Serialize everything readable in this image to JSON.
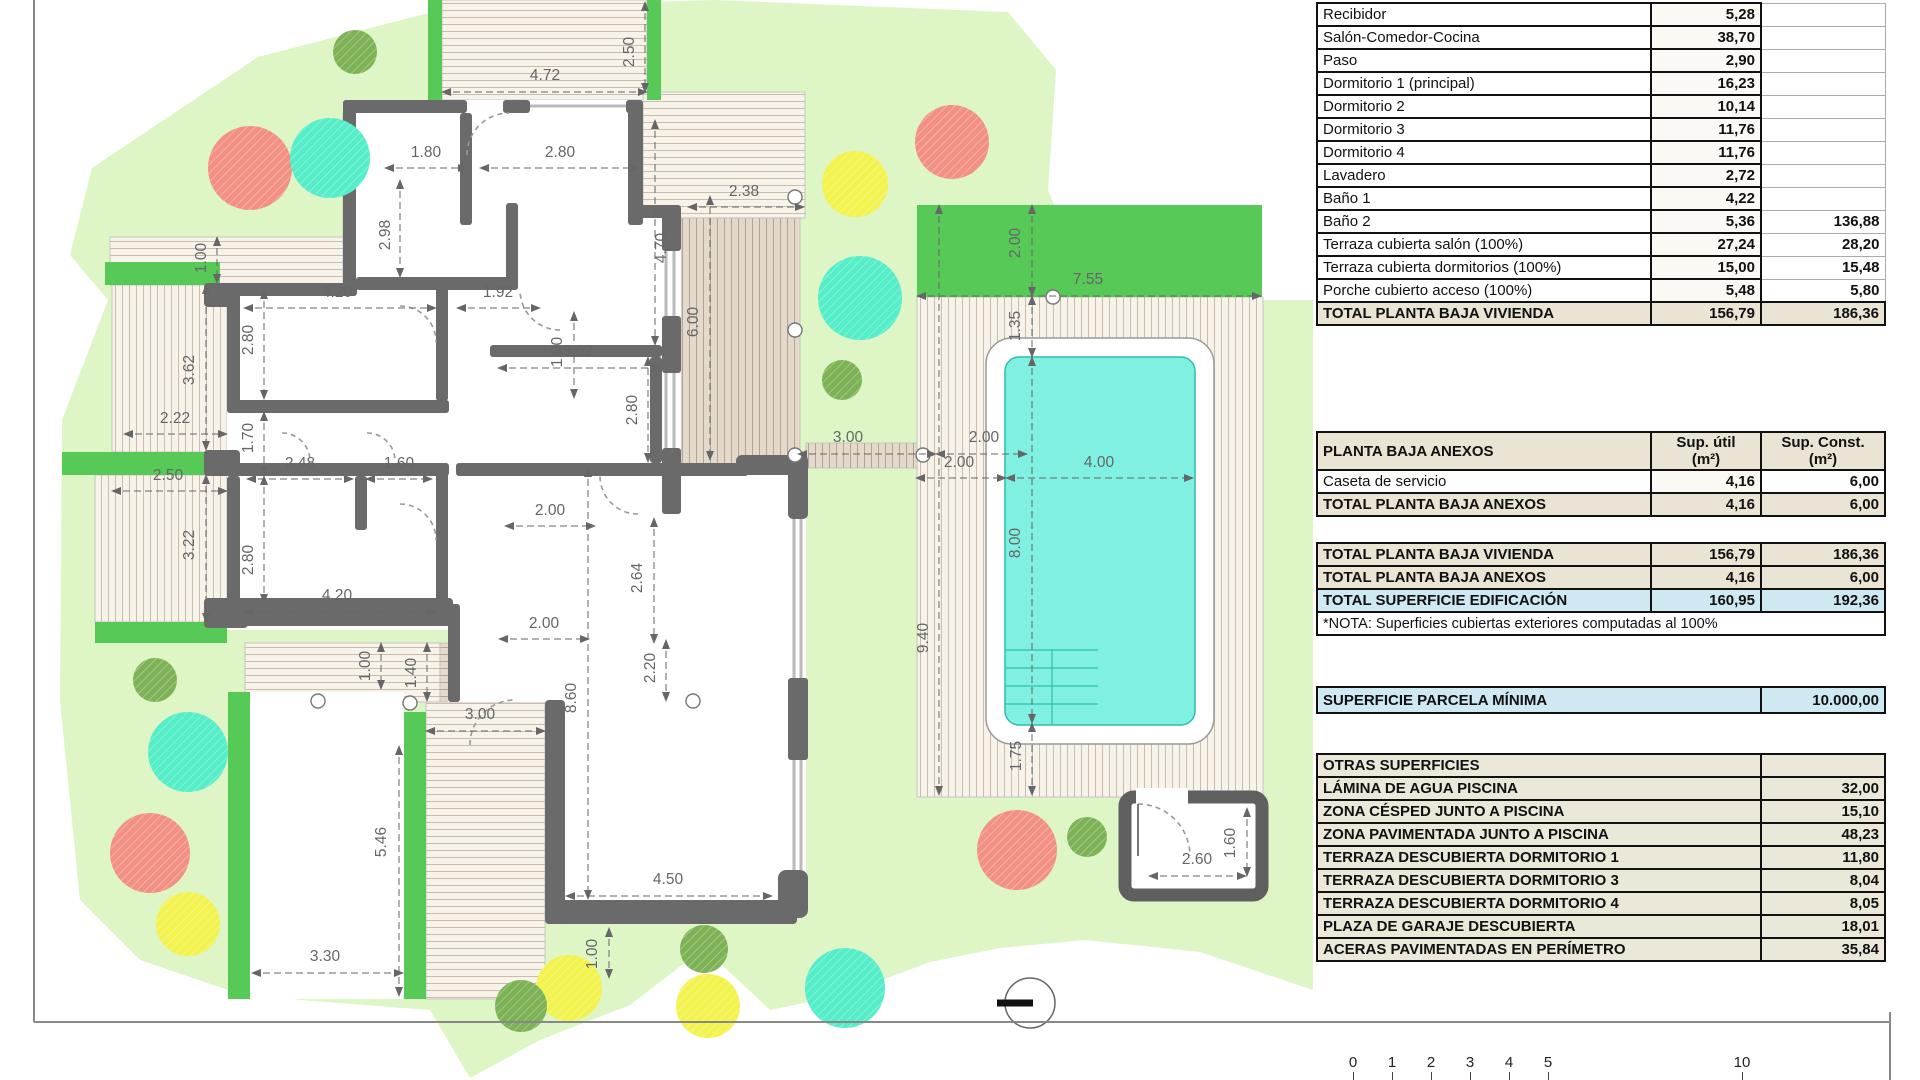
{
  "tables": {
    "planta_baja_vivienda": {
      "rows": [
        {
          "label": "Recibidor",
          "v1": "5,28",
          "v2": ""
        },
        {
          "label": "Salón-Comedor-Cocina",
          "v1": "38,70",
          "v2": ""
        },
        {
          "label": "Paso",
          "v1": "2,90",
          "v2": ""
        },
        {
          "label": "Dormitorio 1 (principal)",
          "v1": "16,23",
          "v2": ""
        },
        {
          "label": "Dormitorio 2",
          "v1": "10,14",
          "v2": ""
        },
        {
          "label": "Dormitorio 3",
          "v1": "11,76",
          "v2": ""
        },
        {
          "label": "Dormitorio 4",
          "v1": "11,76",
          "v2": ""
        },
        {
          "label": "Lavadero",
          "v1": "2,72",
          "v2": ""
        },
        {
          "label": "Baño 1",
          "v1": "4,22",
          "v2": ""
        },
        {
          "label": "Baño 2",
          "v1": "5,36",
          "v2": "136,88"
        },
        {
          "label": "Terraza cubierta salón (100%)",
          "v1": "27,24",
          "v2": "28,20"
        },
        {
          "label": "Terraza cubierta dormitorios (100%)",
          "v1": "15,00",
          "v2": "15,48"
        },
        {
          "label": "Porche cubierto acceso (100%)",
          "v1": "5,48",
          "v2": "5,80"
        }
      ],
      "total": {
        "label": "TOTAL PLANTA BAJA VIVIENDA",
        "v1": "156,79",
        "v2": "186,36"
      }
    },
    "anexos": {
      "header": {
        "label": "PLANTA BAJA ANEXOS",
        "c1": "Sup. útil\n(m²)",
        "c2": "Sup. Const.\n(m²)"
      },
      "rows": [
        {
          "label": "Caseta de servicio",
          "v1": "4,16",
          "v2": "6,00"
        }
      ],
      "total": {
        "label": "TOTAL PLANTA BAJA ANEXOS",
        "v1": "4,16",
        "v2": "6,00"
      }
    },
    "totales": {
      "rows": [
        {
          "label": "TOTAL PLANTA BAJA VIVIENDA",
          "v1": "156,79",
          "v2": "186,36",
          "type": "total"
        },
        {
          "label": "TOTAL PLANTA BAJA ANEXOS",
          "v1": "4,16",
          "v2": "6,00",
          "type": "total"
        },
        {
          "label": "TOTAL SUPERFICIE EDIFICACIÓN",
          "v1": "160,95",
          "v2": "192,36",
          "type": "grand"
        }
      ],
      "note": "*NOTA: Superficies cubiertas exteriores computadas al 100%"
    },
    "parcela": {
      "label": "SUPERFICIE PARCELA MÍNIMA",
      "value": "10.000,00"
    },
    "otras": {
      "header": "OTRAS SUPERFICIES",
      "rows": [
        {
          "label": "LÁMINA DE AGUA PISCINA",
          "value": "32,00"
        },
        {
          "label": "ZONA CÉSPED JUNTO A PISCINA",
          "value": "15,10"
        },
        {
          "label": "ZONA PAVIMENTADA JUNTO A PISCINA",
          "value": "48,23"
        },
        {
          "label": "TERRAZA DESCUBIERTA DORMITORIO 1",
          "value": "11,80"
        },
        {
          "label": "TERRAZA DESCUBIERTA DORMITORIO 3",
          "value": "8,04"
        },
        {
          "label": "TERRAZA DESCUBIERTA DORMITORIO 4",
          "value": "8,05"
        },
        {
          "label": "PLAZA DE GARAJE DESCUBIERTA",
          "value": "18,01"
        },
        {
          "label": "ACERAS PAVIMENTADAS EN PERÍMETRO",
          "value": "35,84"
        }
      ]
    }
  },
  "scale_bar": {
    "labels": [
      [
        "0",
        1353
      ],
      [
        "1",
        1392
      ],
      [
        "2",
        1431
      ],
      [
        "3",
        1470
      ],
      [
        "4",
        1509
      ],
      [
        "5",
        1548
      ],
      [
        "10",
        1742
      ]
    ]
  },
  "plan": {
    "colors": {
      "lawn": "#def5c5",
      "grass": "#56c956",
      "wall": "#6a6a6a",
      "pool_water": "#7ff0e2",
      "pool_edge": "#2bbfae",
      "pave_bg": "#f7f3eb",
      "pave_line": "#c9bca9",
      "pave_dark_bg": "#e4dacc",
      "pave_dark_line": "#b5a292",
      "tree_salmon": "#f29183",
      "tree_teal": "#55eec9",
      "tree_yellow": "#f3f34f",
      "tree_green": "#7db356",
      "dim": "#666666"
    },
    "dim_labels": [
      {
        "t": "4.72",
        "x": 545,
        "y": 80,
        "r": 0,
        "l": [
          442,
          92,
          647,
          92
        ]
      },
      {
        "t": "2.50",
        "x": 634,
        "y": 52,
        "r": 1,
        "l": [
          645,
          2,
          645,
          92
        ]
      },
      {
        "t": "1.80",
        "x": 426,
        "y": 157,
        "r": 0,
        "l": [
          385,
          168,
          467,
          168
        ]
      },
      {
        "t": "2.80",
        "x": 560,
        "y": 157,
        "r": 0,
        "l": [
          480,
          168,
          640,
          168
        ]
      },
      {
        "t": "2.98",
        "x": 390,
        "y": 235,
        "r": 1,
        "l": [
          400,
          180,
          400,
          277
        ]
      },
      {
        "t": "4.70",
        "x": 666,
        "y": 248,
        "r": 1,
        "l": [
          655,
          120,
          655,
          345
        ]
      },
      {
        "t": "1.92",
        "x": 498,
        "y": 297,
        "r": 0,
        "l": [
          457,
          308,
          540,
          308
        ]
      },
      {
        "t": "1.60",
        "x": 562,
        "y": 352,
        "r": 1,
        "l": [
          574,
          312,
          574,
          398
        ]
      },
      {
        "t": "3.62",
        "x": 578,
        "y": 356,
        "r": 0,
        "l": [
          498,
          368,
          660,
          368
        ]
      },
      {
        "t": "2.80",
        "x": 637,
        "y": 410,
        "r": 1,
        "l": [
          648,
          357,
          648,
          462
        ]
      },
      {
        "t": "4.20",
        "x": 337,
        "y": 297,
        "r": 0,
        "l": [
          244,
          308,
          436,
          308
        ]
      },
      {
        "t": "2.80",
        "x": 253,
        "y": 340,
        "r": 1,
        "l": [
          264,
          290,
          264,
          399
        ]
      },
      {
        "t": "3.62",
        "x": 194,
        "y": 370,
        "r": 1,
        "l": [
          206,
          285,
          206,
          450
        ]
      },
      {
        "t": "1.00",
        "x": 206,
        "y": 258,
        "r": 1,
        "l": [
          217,
          237,
          217,
          283
        ]
      },
      {
        "t": "2.22",
        "x": 175,
        "y": 423,
        "r": 0,
        "l": [
          124,
          434,
          227,
          434
        ]
      },
      {
        "t": "2.50",
        "x": 168,
        "y": 480,
        "r": 0,
        "l": [
          112,
          491,
          227,
          491
        ]
      },
      {
        "t": "3.22",
        "x": 194,
        "y": 545,
        "r": 1,
        "l": [
          206,
          475,
          206,
          622
        ]
      },
      {
        "t": "1.70",
        "x": 253,
        "y": 438,
        "r": 1,
        "l": [
          264,
          412,
          264,
          475
        ]
      },
      {
        "t": "2.48",
        "x": 300,
        "y": 468,
        "r": 0,
        "l": [
          247,
          479,
          353,
          479
        ]
      },
      {
        "t": "1.60",
        "x": 399,
        "y": 468,
        "r": 0,
        "l": [
          366,
          479,
          432,
          479
        ]
      },
      {
        "t": "2.80",
        "x": 253,
        "y": 560,
        "r": 1,
        "l": [
          264,
          476,
          264,
          603
        ]
      },
      {
        "t": "4.20",
        "x": 337,
        "y": 600,
        "r": 0,
        "l": [
          244,
          612,
          436,
          612
        ]
      },
      {
        "t": "2.00",
        "x": 550,
        "y": 515,
        "r": 0,
        "l": [
          505,
          526,
          595,
          526
        ]
      },
      {
        "t": "2.64",
        "x": 642,
        "y": 578,
        "r": 1,
        "l": [
          654,
          518,
          654,
          643
        ]
      },
      {
        "t": "2.00",
        "x": 544,
        "y": 628,
        "r": 0,
        "l": [
          499,
          639,
          589,
          639
        ]
      },
      {
        "t": "2.20",
        "x": 655,
        "y": 668,
        "r": 1,
        "l": [
          666,
          640,
          666,
          701
        ]
      },
      {
        "t": "1.00",
        "x": 370,
        "y": 666,
        "r": 1,
        "l": [
          381,
          643,
          381,
          689
        ]
      },
      {
        "t": "1.40",
        "x": 416,
        "y": 673,
        "r": 1,
        "l": [
          427,
          643,
          427,
          701
        ]
      },
      {
        "t": "3.00",
        "x": 480,
        "y": 719,
        "r": 0,
        "l": [
          426,
          731,
          545,
          731
        ]
      },
      {
        "t": "8.60",
        "x": 576,
        "y": 698,
        "r": 1,
        "l": [
          588,
          468,
          588,
          899
        ]
      },
      {
        "t": "4.50",
        "x": 668,
        "y": 884,
        "r": 0,
        "l": [
          566,
          896,
          772,
          896
        ]
      },
      {
        "t": "1.00",
        "x": 597,
        "y": 954,
        "r": 1,
        "l": [
          609,
          928,
          609,
          978
        ]
      },
      {
        "t": "5.46",
        "x": 386,
        "y": 842,
        "r": 1,
        "l": [
          399,
          746,
          399,
          996
        ]
      },
      {
        "t": "3.30",
        "x": 325,
        "y": 961,
        "r": 0,
        "l": [
          252,
          973,
          403,
          973
        ]
      },
      {
        "t": "6.00",
        "x": 698,
        "y": 322,
        "r": 1,
        "l": [
          710,
          196,
          710,
          460
        ]
      },
      {
        "t": "2.38",
        "x": 744,
        "y": 196,
        "r": 0,
        "l": [
          688,
          207,
          804,
          207
        ]
      },
      {
        "t": "3.00",
        "x": 848,
        "y": 442,
        "r": 0,
        "l": [
          798,
          454,
          936,
          454
        ]
      },
      {
        "t": "2.00",
        "x": 984,
        "y": 442,
        "r": 0,
        "l": [
          936,
          454,
          1027,
          454
        ]
      },
      {
        "t": "9.40",
        "x": 928,
        "y": 638,
        "r": 1,
        "l": [
          939,
          205,
          939,
          795
        ]
      },
      {
        "t": "7.55",
        "x": 1088,
        "y": 284,
        "r": 0,
        "l": [
          917,
          296,
          1261,
          296
        ]
      },
      {
        "t": "2.00",
        "x": 1020,
        "y": 243,
        "r": 1,
        "l": [
          1032,
          205,
          1032,
          296
        ]
      },
      {
        "t": "1.35",
        "x": 1020,
        "y": 326,
        "r": 1,
        "l": [
          1032,
          296,
          1032,
          357
        ]
      },
      {
        "t": "4.00",
        "x": 1099,
        "y": 467,
        "r": 0,
        "l": [
          1006,
          478,
          1193,
          478
        ]
      },
      {
        "t": "2.00",
        "x": 959,
        "y": 467,
        "r": 0,
        "l": [
          916,
          478,
          1006,
          478
        ]
      },
      {
        "t": "8.00",
        "x": 1020,
        "y": 543,
        "r": 1,
        "l": [
          1032,
          357,
          1032,
          723
        ]
      },
      {
        "t": "1.75",
        "x": 1021,
        "y": 756,
        "r": 1,
        "l": [
          1032,
          723,
          1032,
          795
        ]
      },
      {
        "t": "2.60",
        "x": 1197,
        "y": 864,
        "r": 0,
        "l": [
          1149,
          876,
          1246,
          876
        ]
      },
      {
        "t": "1.60",
        "x": 1235,
        "y": 843,
        "r": 1,
        "l": [
          1247,
          808,
          1247,
          876
        ]
      }
    ],
    "trees": [
      {
        "x": 250,
        "y": 168,
        "r": 42,
        "c": "tree_salmon"
      },
      {
        "x": 952,
        "y": 142,
        "r": 37,
        "c": "tree_salmon"
      },
      {
        "x": 1017,
        "y": 850,
        "r": 40,
        "c": "tree_salmon"
      },
      {
        "x": 150,
        "y": 853,
        "r": 40,
        "c": "tree_salmon"
      },
      {
        "x": 330,
        "y": 158,
        "r": 40,
        "c": "tree_teal"
      },
      {
        "x": 860,
        "y": 298,
        "r": 42,
        "c": "tree_teal"
      },
      {
        "x": 188,
        "y": 752,
        "r": 40,
        "c": "tree_teal"
      },
      {
        "x": 845,
        "y": 988,
        "r": 40,
        "c": "tree_teal"
      },
      {
        "x": 855,
        "y": 184,
        "r": 33,
        "c": "tree_yellow"
      },
      {
        "x": 188,
        "y": 924,
        "r": 32,
        "c": "tree_yellow"
      },
      {
        "x": 569,
        "y": 988,
        "r": 33,
        "c": "tree_yellow"
      },
      {
        "x": 708,
        "y": 1006,
        "r": 32,
        "c": "tree_yellow"
      },
      {
        "x": 355,
        "y": 52,
        "r": 22,
        "c": "tree_green"
      },
      {
        "x": 842,
        "y": 380,
        "r": 20,
        "c": "tree_green"
      },
      {
        "x": 1087,
        "y": 837,
        "r": 20,
        "c": "tree_green"
      },
      {
        "x": 155,
        "y": 680,
        "r": 22,
        "c": "tree_green"
      },
      {
        "x": 521,
        "y": 1006,
        "r": 26,
        "c": "tree_green"
      },
      {
        "x": 704,
        "y": 949,
        "r": 24,
        "c": "tree_green"
      }
    ],
    "columns": [
      {
        "x": 795,
        "y": 197
      },
      {
        "x": 795,
        "y": 330
      },
      {
        "x": 795,
        "y": 455
      },
      {
        "x": 923,
        "y": 455
      },
      {
        "x": 1053,
        "y": 297
      },
      {
        "x": 318,
        "y": 701
      },
      {
        "x": 410,
        "y": 703
      },
      {
        "x": 693,
        "y": 701
      }
    ]
  }
}
